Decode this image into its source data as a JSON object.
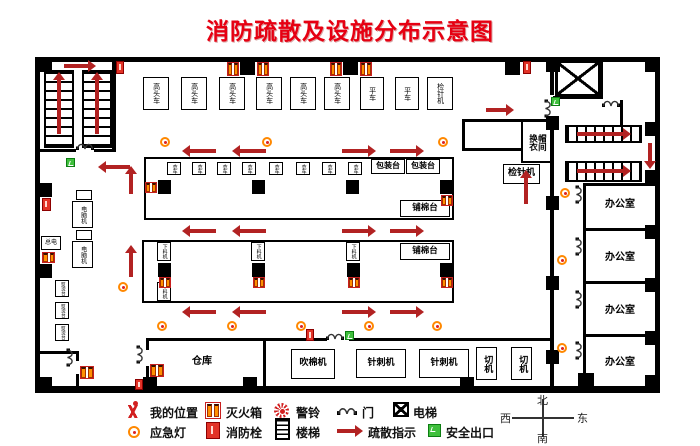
{
  "title": "消防疏散及设施分布示意图",
  "top_row": [
    "高头车",
    "高头车",
    "高头车",
    "高头车",
    "高头车",
    "高头车",
    "平车",
    "平车",
    "检针机"
  ],
  "hall": {
    "table1": {
      "sew": [
        "衣车",
        "衣车",
        "衣车",
        "衣车",
        "衣车",
        "衣车",
        "衣车",
        "衣车"
      ],
      "pack": [
        "包装台",
        "包装台"
      ],
      "cotton": "铺棉台"
    },
    "table2": {
      "feed": [
        "下料机",
        "下料机",
        "下料机",
        "下料机"
      ],
      "cotton": "铺棉台"
    }
  },
  "left_wing": {
    "computer": [
      "电脑机",
      "电脑机"
    ],
    "power": "总电",
    "iron": [
      "熨烫台",
      "熨烫台",
      "熨烫台"
    ]
  },
  "right_wing": {
    "cloak_room": "换衣帽间",
    "needle_detector": "检针机",
    "offices": [
      "办公室",
      "办公室",
      "办公室",
      "办公室"
    ]
  },
  "bottom_row": {
    "warehouse": "仓库",
    "machines": [
      "吹棉机",
      "针刺机",
      "针刺机",
      "切机",
      "切机"
    ]
  },
  "legend": {
    "row1": [
      {
        "icon": "person-icon",
        "label": "我的位置"
      },
      {
        "icon": "fire-extinguisher-box-icon",
        "label": "灭火箱"
      },
      {
        "icon": "alarm-bell-icon",
        "label": "警铃"
      },
      {
        "icon": "door-icon",
        "label": "门"
      },
      {
        "icon": "elevator-icon",
        "label": "电梯"
      }
    ],
    "row2": [
      {
        "icon": "emergency-light-icon",
        "label": "应急灯"
      },
      {
        "icon": "fire-hydrant-icon",
        "label": "消防栓"
      },
      {
        "icon": "stairs-icon",
        "label": "楼梯"
      },
      {
        "icon": "evacuation-arrow-icon",
        "label": "疏散指示"
      },
      {
        "icon": "safe-exit-icon",
        "label": "安全出口"
      }
    ]
  },
  "compass": {
    "n": "北",
    "s": "南",
    "w": "西",
    "e": "东"
  },
  "colors": {
    "title_red": "#e60012",
    "arrow_red": "#b22222",
    "wall_black": "#000000",
    "hydrant_red": "#e23327",
    "extinguisher_orange": "#ff9000",
    "emergency_light_orange": "#ff8800",
    "exit_green": "#3fbf3c"
  }
}
